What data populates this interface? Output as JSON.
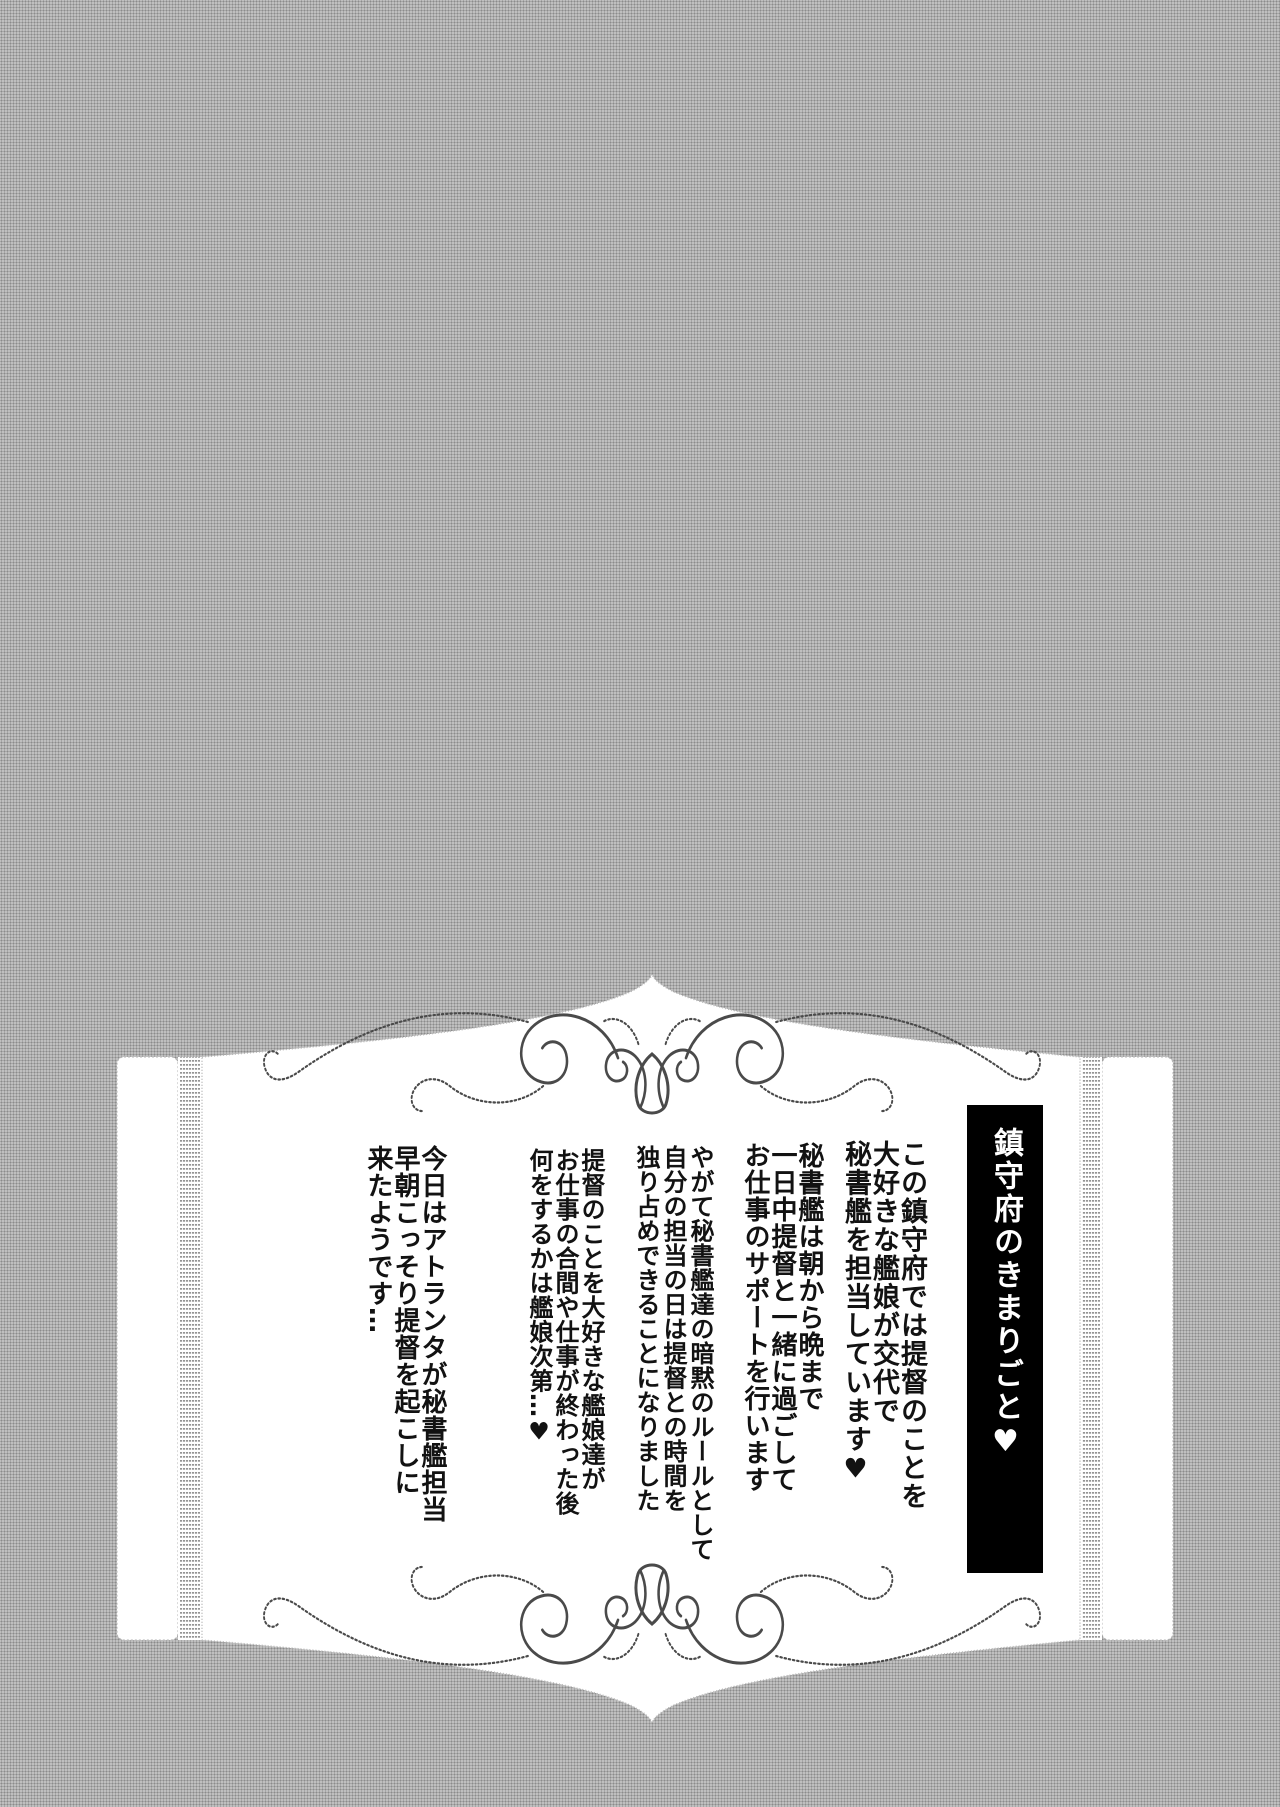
{
  "colors": {
    "background_gray": "#ababab",
    "panel_white": "#ffffff",
    "ink": "#121212",
    "banner_background": "#000000",
    "banner_text": "#ffffff",
    "ornament_gray": "#4a4a4a"
  },
  "plaque": {
    "title": "鎮守府のきまりごと♥",
    "paragraphs": [
      {
        "text": "この鎮守府では提督のことを\n大好きな艦娘が交代で\n秘書艦を担当しています♥"
      },
      {
        "text": "秘書艦は朝から晩まで\n一日中提督と一緒に過ごして\nお仕事のサポートを行います"
      },
      {
        "text": "やがて秘書艦達の暗黙のルールとして\n自分の担当の日は提督との時間を\n独り占めできることになりました"
      },
      {
        "text": "提督のことを大好きな艦娘達が\nお仕事の合間や仕事が終わった後\n何をするかは艦娘次第…♥"
      },
      {
        "text": "今日はアトランタが秘書艦担当\n早朝こっそり提督を起こしに\n来たようです…"
      }
    ]
  }
}
